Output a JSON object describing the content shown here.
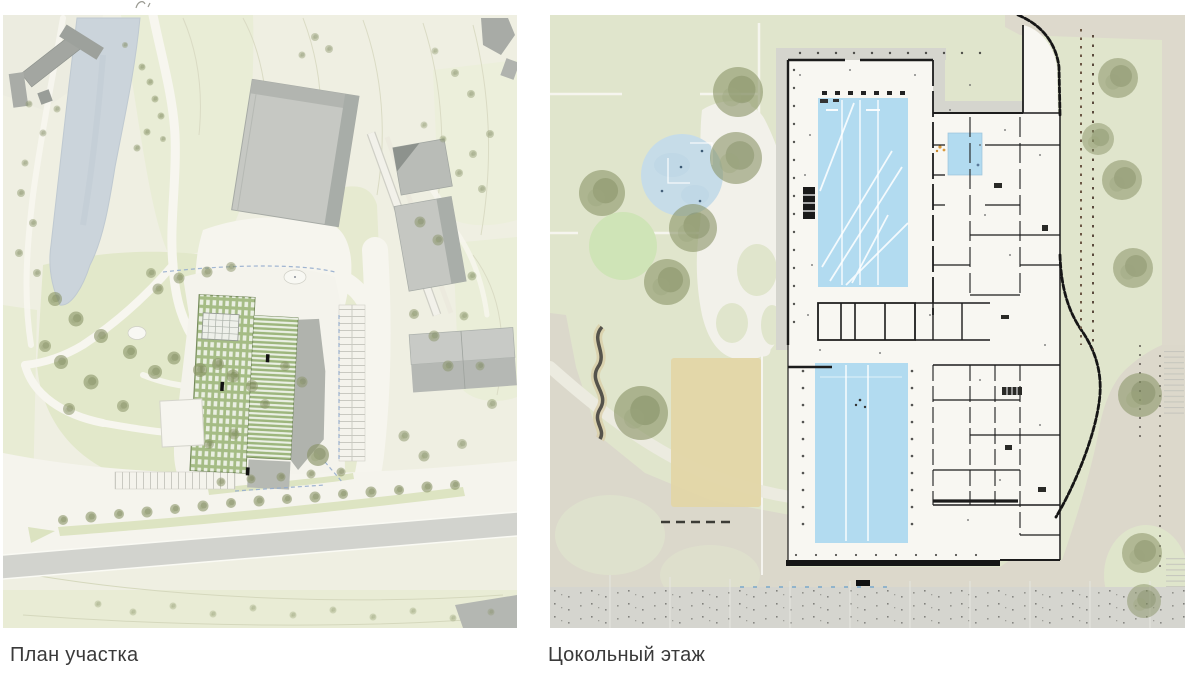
{
  "page": {
    "background": "#ffffff"
  },
  "panels": [
    {
      "id": "site-plan",
      "caption": "План участка"
    },
    {
      "id": "basement-floor-plan",
      "caption": "Цокольный этаж"
    }
  ],
  "palette": {
    "site_background": "#efefe2",
    "site_greenery": "#e7ebd2",
    "water_blue": "#cbd4db",
    "building_gray": "#c3c5c0",
    "building_gray_dark": "#9ba09b",
    "green_roof": "#a5bc85",
    "road_gray": "#d2d3ce",
    "plan_background": "#e0e5cc",
    "pool_blue": "#b2dbf0",
    "pond_blue": "#c6dce8",
    "lawn_green": "#cfe4b7",
    "sand_tan": "#e3d6a7",
    "paving_beige": "#dcd8cb",
    "paving_gray": "#d5d5cf",
    "tree_olive": "#87926a",
    "wall_black": "#1c1c1c",
    "caption_text": "#3a3a3a"
  }
}
